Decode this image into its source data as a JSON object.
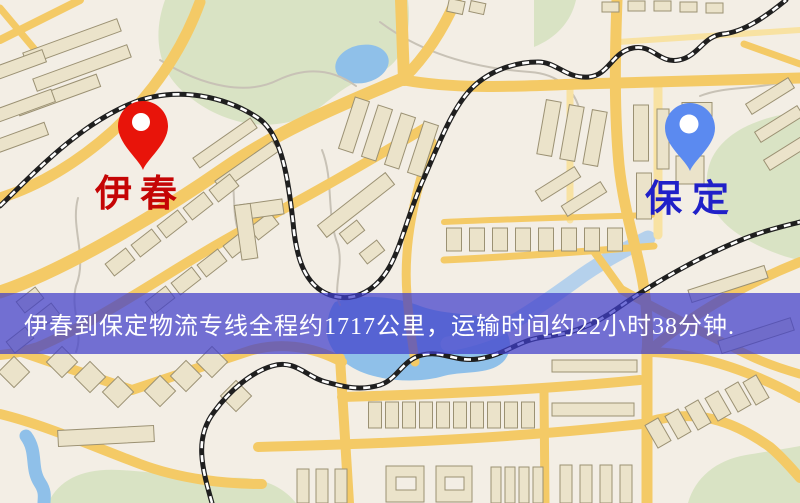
{
  "banner": {
    "text": "伊春到保定物流专线全程约1717公里，运输时间约22小时38分钟."
  },
  "markers": {
    "origin": {
      "label": "伊春",
      "pin": "red-pin"
    },
    "destination": {
      "label": "保定",
      "pin": "blue-pin"
    }
  },
  "palette": {
    "map_background": "#f3eee5",
    "park": "#d9e3c4",
    "water": "#8fc0e9",
    "water_light": "#aecdec",
    "road": "#f4ca66",
    "road_minor": "#f8e2a2",
    "building_fill": "#ebe3ca",
    "building_stroke": "#9b9173",
    "railway": "#1f1f1f",
    "railway_dash": "#ffffff",
    "path": "#c8c2b6",
    "pin_red": "#e8140a",
    "pin_blue": "#5b8af0",
    "label_red": "#c50505",
    "label_blue": "#2020c8",
    "banner_bg": "rgba(64,62,202,0.72)",
    "banner_text": "#ffffff"
  }
}
